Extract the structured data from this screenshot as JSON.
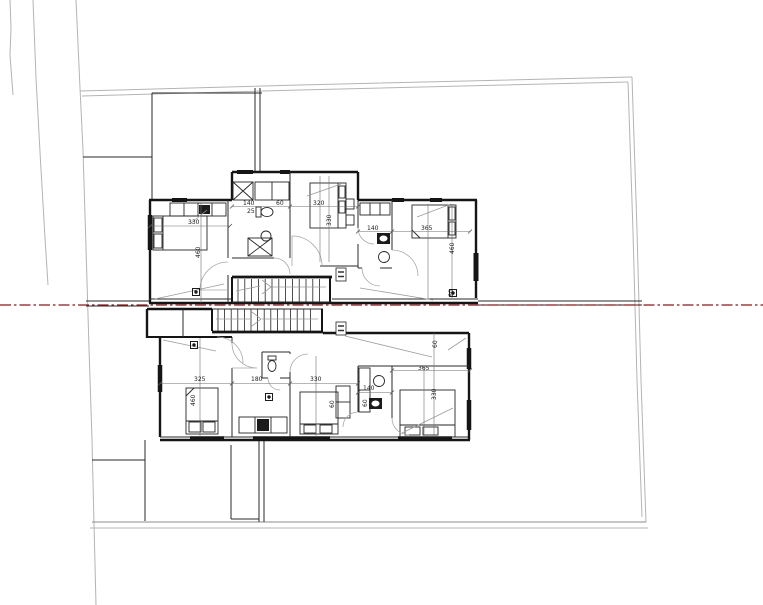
{
  "drawing": {
    "title": "residential floor plan with section line",
    "units_shown": 2
  },
  "colors": {
    "background": "#ffffff",
    "wall": "#151515",
    "boundary": "#b4b4b4",
    "leader": "#9c9c9c",
    "section_line": "#7f1d1d",
    "label_text": "#222222"
  },
  "section_line": {
    "style": "dash-dot",
    "y": 305
  },
  "dimension_labels": [
    {
      "text": "330",
      "x": 188,
      "y": 224,
      "rot": 0
    },
    {
      "text": "460",
      "x": 200,
      "y": 258,
      "rot": 1
    },
    {
      "text": "140",
      "x": 243,
      "y": 205,
      "rot": 0
    },
    {
      "text": "25",
      "x": 247,
      "y": 213,
      "rot": 0
    },
    {
      "text": "60",
      "x": 276,
      "y": 205,
      "rot": 0
    },
    {
      "text": "320",
      "x": 313,
      "y": 205,
      "rot": 0
    },
    {
      "text": "330",
      "x": 331,
      "y": 226,
      "rot": 1
    },
    {
      "text": "140",
      "x": 367,
      "y": 230,
      "rot": 0
    },
    {
      "text": "365",
      "x": 421,
      "y": 230,
      "rot": 0
    },
    {
      "text": "460",
      "x": 454,
      "y": 254,
      "rot": 1
    },
    {
      "text": "60",
      "x": 453,
      "y": 297,
      "rot": 1
    },
    {
      "text": "325",
      "x": 194,
      "y": 381,
      "rot": 0
    },
    {
      "text": "460",
      "x": 195,
      "y": 406,
      "rot": 1
    },
    {
      "text": "180",
      "x": 251,
      "y": 381,
      "rot": 0
    },
    {
      "text": "330",
      "x": 310,
      "y": 381,
      "rot": 0
    },
    {
      "text": "60",
      "x": 334,
      "y": 408,
      "rot": 1
    },
    {
      "text": "140",
      "x": 363,
      "y": 390,
      "rot": 0
    },
    {
      "text": "60",
      "x": 367,
      "y": 407,
      "rot": 1
    },
    {
      "text": "365",
      "x": 418,
      "y": 370,
      "rot": 0
    },
    {
      "text": "330",
      "x": 436,
      "y": 400,
      "rot": 1
    },
    {
      "text": "60",
      "x": 437,
      "y": 348,
      "rot": 1
    }
  ],
  "point_markers": [
    {
      "x": 196,
      "y": 292
    },
    {
      "x": 453,
      "y": 293
    },
    {
      "x": 194,
      "y": 345
    },
    {
      "x": 269,
      "y": 397
    }
  ],
  "level_tags": [
    {
      "x": 336,
      "y": 268
    },
    {
      "x": 336,
      "y": 322
    }
  ]
}
